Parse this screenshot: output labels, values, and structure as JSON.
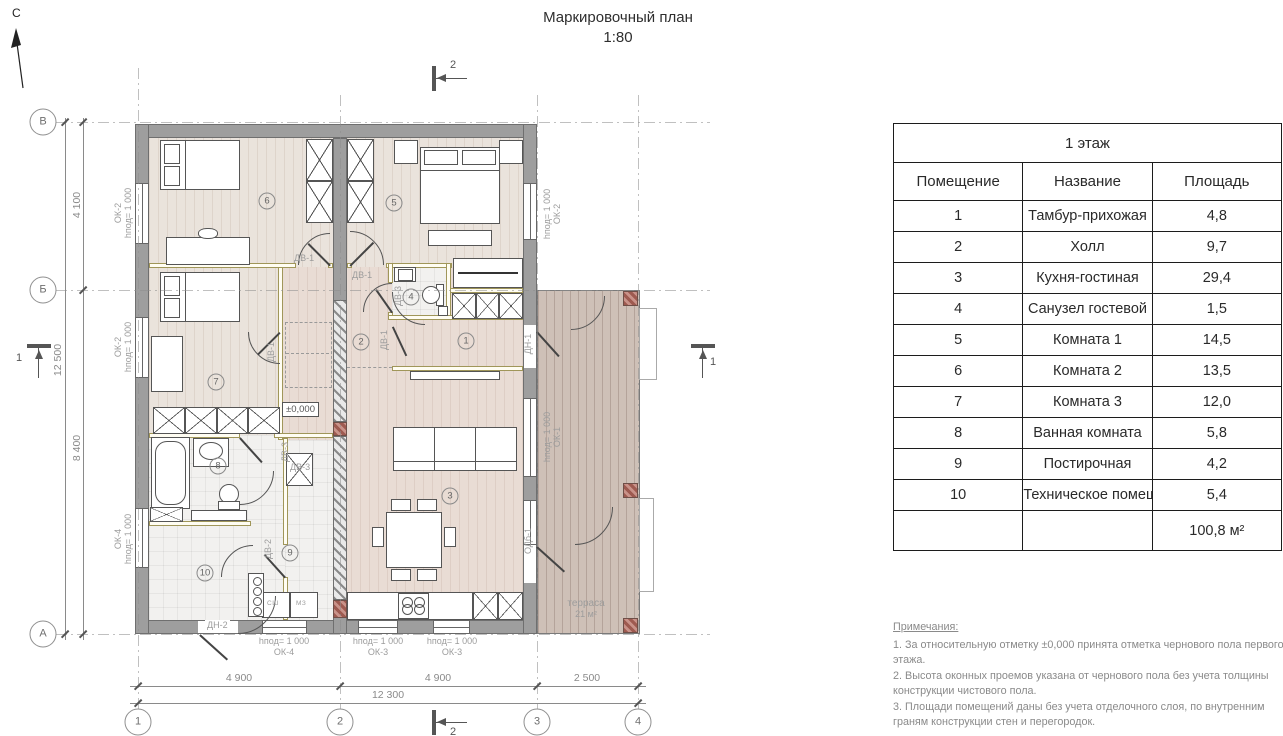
{
  "north_label": "С",
  "title": {
    "line1": "Маркировочный план",
    "line2": "1:80"
  },
  "section_marks": {
    "one": "1",
    "two": "2"
  },
  "axes": {
    "rows": [
      "В",
      "Б",
      "А"
    ],
    "cols": [
      "1",
      "2",
      "3",
      "4"
    ]
  },
  "dimensions": {
    "left_top": "4 100",
    "left_bottom": "8 400",
    "left_overall": "12 500",
    "bottom_spans": [
      "4 900",
      "4 900",
      "2 500"
    ],
    "bottom_overall": "12 300"
  },
  "level_mark": "±0,000",
  "window_types": {
    "ok1": "ОК-1",
    "ok2": "ОК-2",
    "ok3": "ОК-3",
    "ok4": "ОК-4",
    "odb": "ОДб-1",
    "sill": "hпод= 1 000"
  },
  "door_types": {
    "dv1": "ДВ-1",
    "dv2": "ДВ-2",
    "dv3": "ДВ-3",
    "dn1": "ДН-1",
    "dn2": "ДН-2"
  },
  "terrace": {
    "name": "терраса",
    "area": "21 м²"
  },
  "appliances": [
    "СШ",
    "МЗ"
  ],
  "table": {
    "title": "1 этаж",
    "headers": [
      "Помещение",
      "Название",
      "Площадь"
    ],
    "rows": [
      {
        "num": "1",
        "name": "Тамбур-прихожая",
        "area": "4,8"
      },
      {
        "num": "2",
        "name": "Холл",
        "area": "9,7"
      },
      {
        "num": "3",
        "name": "Кухня-гостиная",
        "area": "29,4"
      },
      {
        "num": "4",
        "name": "Санузел гостевой",
        "area": "1,5"
      },
      {
        "num": "5",
        "name": "Комната 1",
        "area": "14,5"
      },
      {
        "num": "6",
        "name": "Комната 2",
        "area": "13,5"
      },
      {
        "num": "7",
        "name": "Комната 3",
        "area": "12,0"
      },
      {
        "num": "8",
        "name": "Ванная комната",
        "area": "5,8"
      },
      {
        "num": "9",
        "name": "Постирочная",
        "area": "4,2"
      },
      {
        "num": "10",
        "name": "Техническое помещение",
        "area": "5,4"
      }
    ],
    "total": "100,8 м²"
  },
  "notes": {
    "heading": "Примечания:",
    "items": [
      "1. За относительную отметку ±0,000 принята отметка чернового пола первого этажа.",
      "2. Высота оконных проемов указана от чернового пола без учета толщины конструкции чистового пола.",
      "3. Площади помещений даны без учета отделочного слоя, по внутренним граням конструкции стен и перегородок."
    ]
  }
}
